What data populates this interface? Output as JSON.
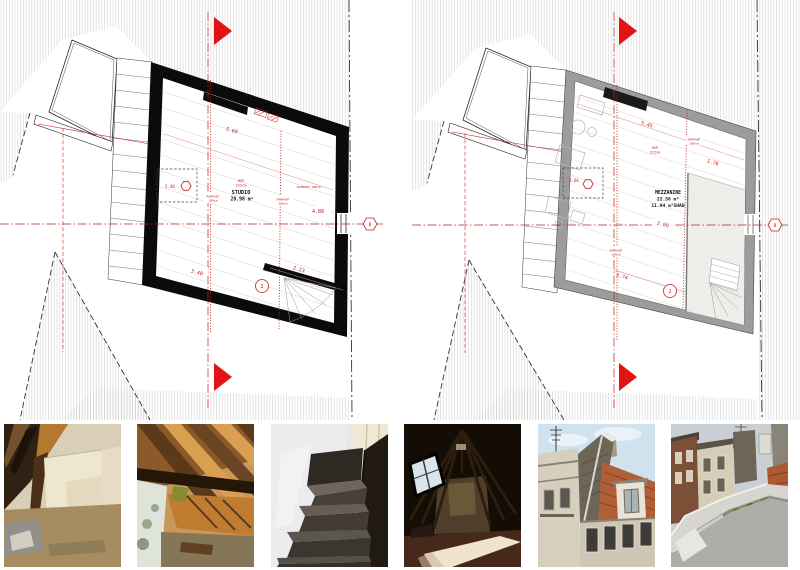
{
  "sheet": {
    "background": "#ffffff",
    "accent_red": "#c42020",
    "arrow_red": "#e01414",
    "wall_black": "#0b0b0b",
    "wall_gray": "#9c9c9c"
  },
  "plans": {
    "left": {
      "room_label": "STUDIO",
      "room_area": "28.98 m²",
      "height_label": "HSP",
      "height_value": "222cm",
      "dim_top": "5.69",
      "dim_right": "4.88",
      "dim_bottom_right": "2.23",
      "dim_bottom_center": "3.40",
      "rampant_label": "RAMPANT",
      "rampant_value": "180cm",
      "rampant_inline": "RAMPANT 180cm",
      "spot_level": "5.40",
      "stair_marker": "2",
      "axis_marker": "B"
    },
    "right": {
      "room_label": "MEZZANINE",
      "room_area": "22.56 m²",
      "room_area_shab": "11.84 m²SHAB",
      "height_label": "HSP",
      "height_value": "222cm",
      "dim_top": "5.45",
      "dim_right": "1.76",
      "dim_mid": "2.09",
      "dim_bottom_center": "3.74",
      "rampant_label": "RAMPANT",
      "rampant_value": "180cm",
      "spot_level": "5.66",
      "stair_marker": "2",
      "axis_marker": "B"
    }
  },
  "photos": [
    {
      "name": "attic-beams-corner"
    },
    {
      "name": "attic-roof-insulation"
    },
    {
      "name": "carpeted-staircase"
    },
    {
      "name": "dark-attic-skylight"
    },
    {
      "name": "street-roofs-facades"
    },
    {
      "name": "rooftop-parapet-gutter"
    }
  ]
}
